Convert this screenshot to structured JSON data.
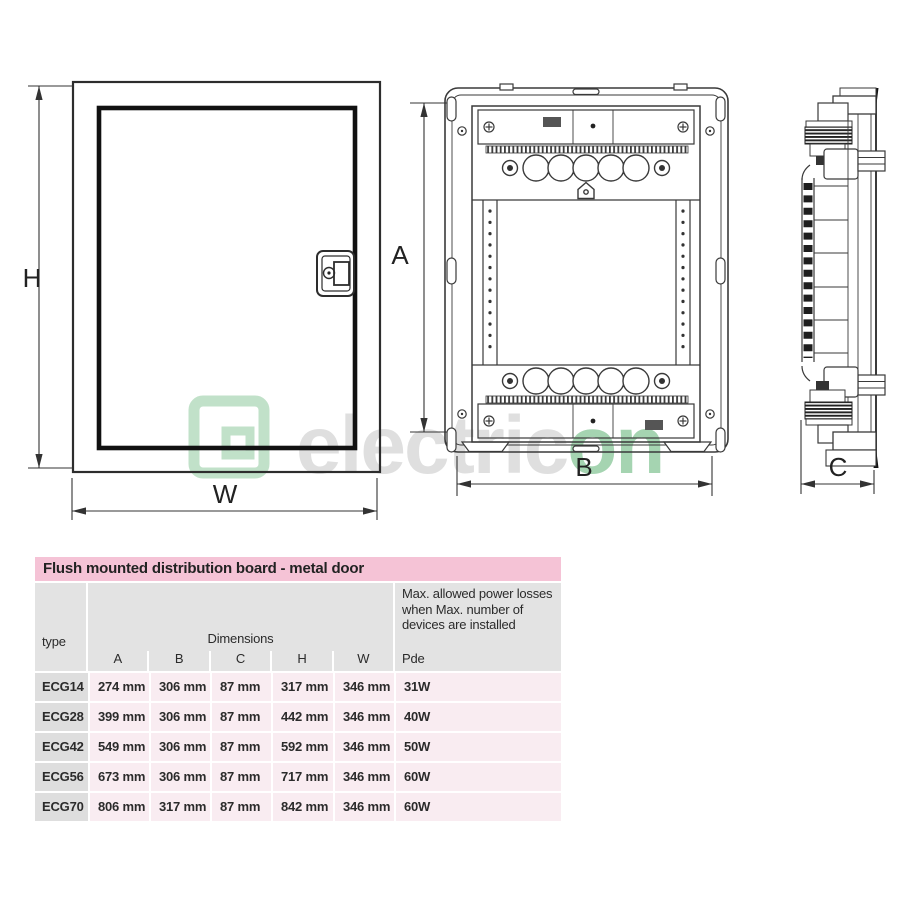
{
  "watermark": {
    "gray_text": "electric",
    "green_text": "on",
    "green": "#8fca9e",
    "gray": "#d8d8d8"
  },
  "dims": {
    "h": "H",
    "w": "W",
    "a": "A",
    "b": "B",
    "c": "C"
  },
  "table": {
    "title": "Flush mounted distribution board - metal door",
    "type_header": "type",
    "dimensions_header": "Dimensions",
    "power_header": "Max. allowed power losses when Max. number of devices are installed",
    "sub_headers": [
      "A",
      "B",
      "C",
      "H",
      "W",
      "Pde"
    ],
    "rows": [
      [
        "ECG14",
        "274 mm",
        "306 mm",
        "87 mm",
        "317 mm",
        "346 mm",
        "31W"
      ],
      [
        "ECG28",
        "399 mm",
        "306 mm",
        "87 mm",
        "442 mm",
        "346 mm",
        "40W"
      ],
      [
        "ECG42",
        "549 mm",
        "306 mm",
        "87 mm",
        "592 mm",
        "346 mm",
        "50W"
      ],
      [
        "ECG56",
        "673 mm",
        "306 mm",
        "87 mm",
        "717 mm",
        "346 mm",
        "60W"
      ],
      [
        "ECG70",
        "806 mm",
        "317 mm",
        "87 mm",
        "842 mm",
        "346 mm",
        "60W"
      ]
    ],
    "colors": {
      "title_bg": "#f5c3d6",
      "header_bg": "#e3e3e3",
      "type_col_bg": "#dedede",
      "row_bg": "#f9ecf1"
    }
  }
}
